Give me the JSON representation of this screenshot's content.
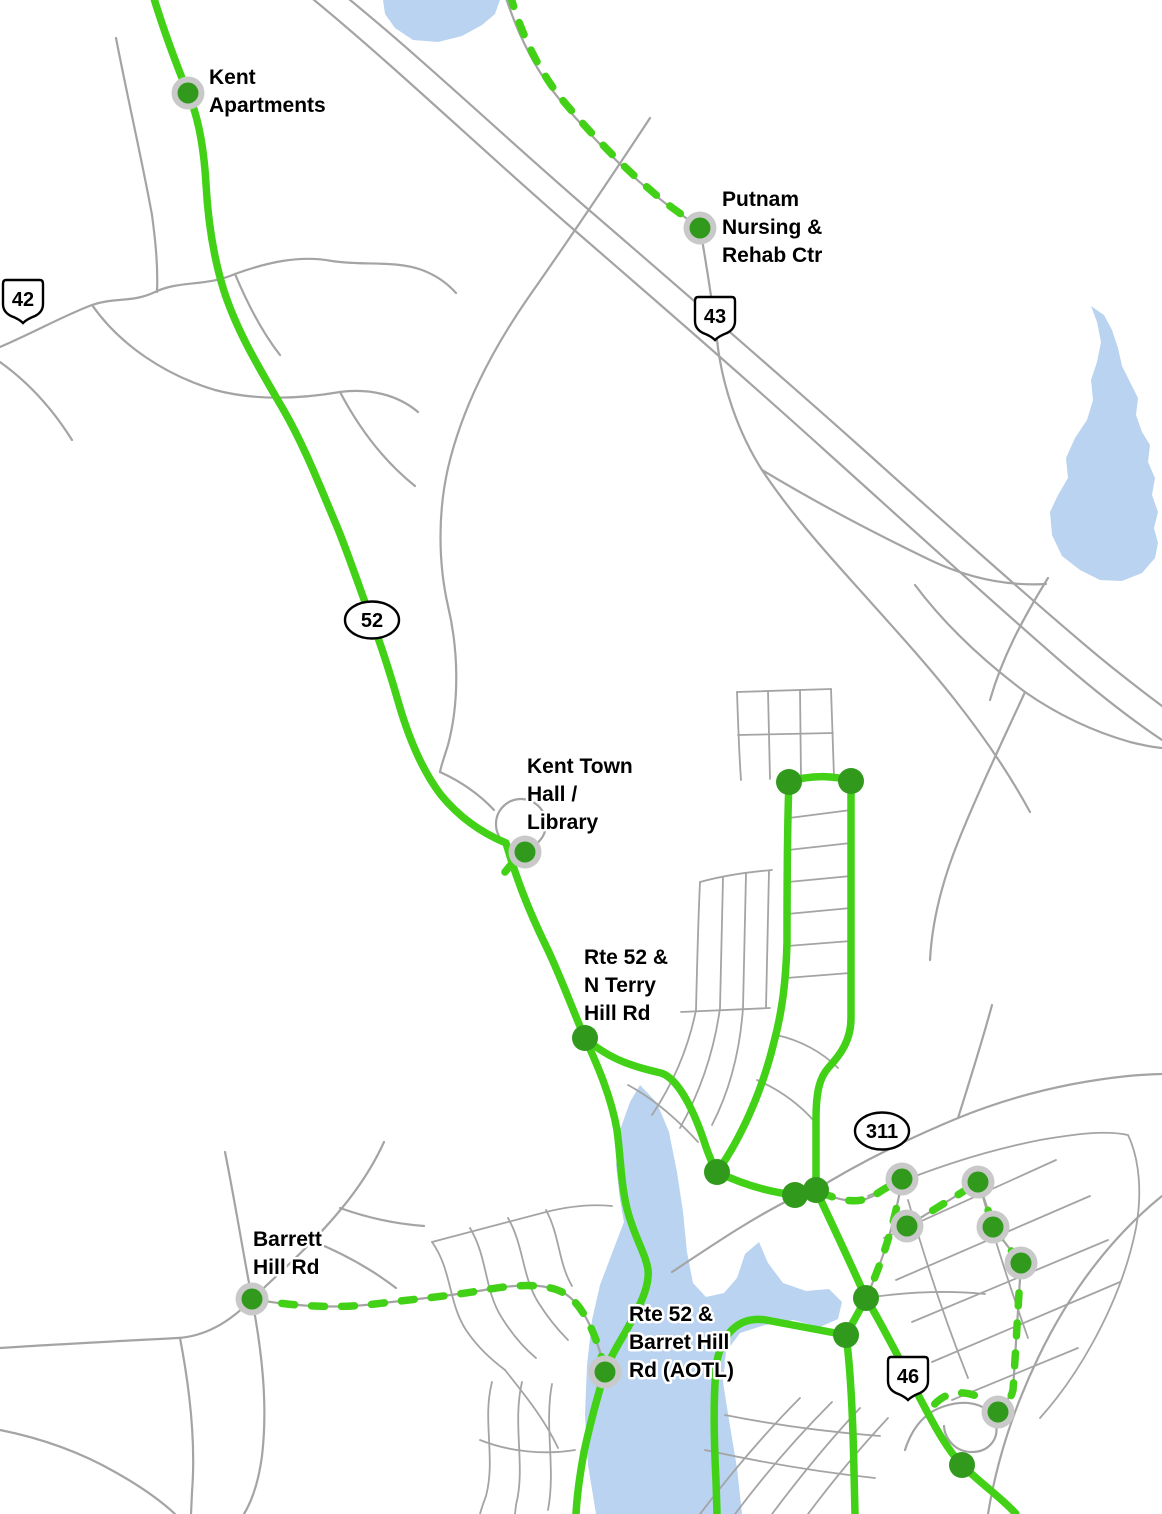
{
  "map": {
    "type": "transit-route-map",
    "colors": {
      "route_green": "#42d117",
      "stop_green": "#319a1d",
      "stop_halo_gray": "#c9c9c9",
      "road_gray": "#a4a4a4",
      "water_blue": "#b9d3f0",
      "background": "#ffffff",
      "label_text": "#000000",
      "shield_fill": "#ffffff",
      "shield_border": "#000000"
    },
    "label_line_height": 28,
    "stops": [
      {
        "id": "kent-apartments",
        "lines": [
          "Kent",
          "Apartments"
        ],
        "x": 188,
        "y": 93,
        "halo": true,
        "label_x": 209,
        "label_y": 84
      },
      {
        "id": "putnam-nursing-rehab-ctr",
        "lines": [
          "Putnam",
          "Nursing &",
          "Rehab Ctr"
        ],
        "x": 700,
        "y": 228,
        "halo": true,
        "label_x": 722,
        "label_y": 206
      },
      {
        "id": "kent-town-hall-library",
        "lines": [
          "Kent Town",
          "Hall /",
          "Library"
        ],
        "x": 525,
        "y": 852,
        "halo": true,
        "label_x": 527,
        "label_y": 773
      },
      {
        "id": "rte-52-n-terry-hill-rd",
        "lines": [
          "Rte 52 &",
          "N Terry",
          "Hill Rd"
        ],
        "x": 585,
        "y": 1038,
        "halo": false,
        "label_x": 584,
        "label_y": 964
      },
      {
        "id": "barrett-hill-rd",
        "lines": [
          "Barrett",
          "Hill Rd"
        ],
        "x": 252,
        "y": 1299,
        "halo": true,
        "label_x": 253,
        "label_y": 1246
      },
      {
        "id": "rte-52-barret-hill-rd-aotl",
        "lines": [
          "Rte 52 &",
          "Barret Hill",
          "Rd (AOTL)"
        ],
        "x": 605,
        "y": 1372,
        "halo": true,
        "label_x": 629,
        "label_y": 1321
      },
      {
        "id": "stop-east-1",
        "lines": [],
        "x": 902,
        "y": 1179,
        "halo": true,
        "label_x": 0,
        "label_y": 0
      },
      {
        "id": "stop-east-2",
        "lines": [],
        "x": 978,
        "y": 1182,
        "halo": true,
        "label_x": 0,
        "label_y": 0
      },
      {
        "id": "stop-east-3",
        "lines": [],
        "x": 907,
        "y": 1226,
        "halo": true,
        "label_x": 0,
        "label_y": 0
      },
      {
        "id": "stop-east-4",
        "lines": [],
        "x": 993,
        "y": 1227,
        "halo": true,
        "label_x": 0,
        "label_y": 0
      },
      {
        "id": "stop-east-5",
        "lines": [],
        "x": 1021,
        "y": 1263,
        "halo": true,
        "label_x": 0,
        "label_y": 0
      },
      {
        "id": "stop-east-6",
        "lines": [],
        "x": 998,
        "y": 1412,
        "halo": true,
        "label_x": 0,
        "label_y": 0
      }
    ],
    "waypoints": [
      {
        "id": "loop-top-left",
        "x": 789,
        "y": 782
      },
      {
        "id": "loop-top-right",
        "x": 851,
        "y": 781
      },
      {
        "id": "junction-west",
        "x": 717,
        "y": 1172
      },
      {
        "id": "junction-center-a",
        "x": 795,
        "y": 1195
      },
      {
        "id": "junction-center-b",
        "x": 816,
        "y": 1190
      },
      {
        "id": "junction-east-a",
        "x": 866,
        "y": 1298
      },
      {
        "id": "junction-east-b",
        "x": 846,
        "y": 1335
      },
      {
        "id": "junction-south",
        "x": 962,
        "y": 1465
      }
    ],
    "shields": [
      {
        "id": "route-42",
        "number": "42",
        "shape": "pentagon",
        "x": 23,
        "y": 300
      },
      {
        "id": "route-43",
        "number": "43",
        "shape": "pentagon",
        "x": 715,
        "y": 317
      },
      {
        "id": "route-52",
        "number": "52",
        "shape": "ellipse",
        "x": 372,
        "y": 620
      },
      {
        "id": "route-311",
        "number": "311",
        "shape": "ellipse",
        "x": 882,
        "y": 1131
      },
      {
        "id": "route-46",
        "number": "46",
        "shape": "pentagon",
        "x": 908,
        "y": 1377
      }
    ]
  }
}
